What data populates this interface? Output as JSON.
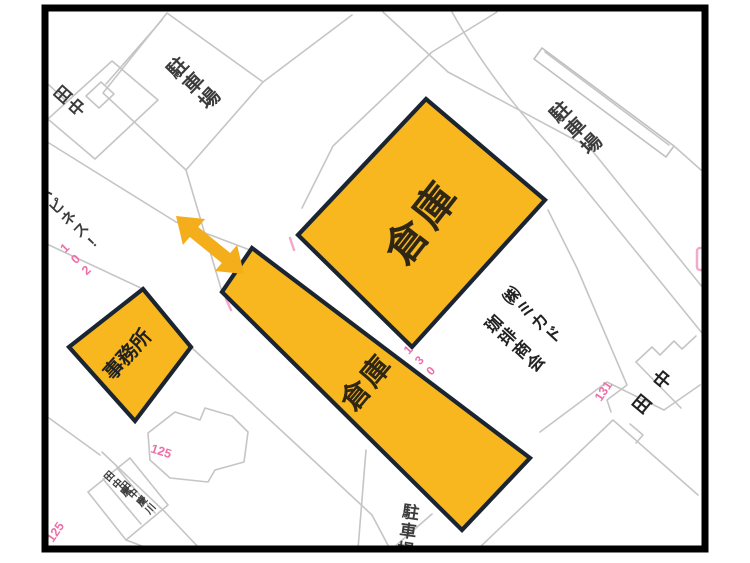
{
  "map": {
    "buildings": {
      "warehouse_large": {
        "label": "倉庫"
      },
      "warehouse_long": {
        "label": "倉庫"
      },
      "office": {
        "label": "事務所"
      }
    },
    "labels": {
      "parking_top_left": "駐車場",
      "parking_top_right": "駐車場",
      "parking_bottom": "駐車場",
      "tanaka_top_left": "田中",
      "tanaka_right": "田中",
      "happiness": "ハピネス!",
      "mikado_line1": "㈱ミカド",
      "mikado_line2": "珈琲商会"
    },
    "names_bottom": [
      "田中慶",
      "田中慶川"
    ],
    "numbers": {
      "num_102": "102",
      "num_125_a": "125",
      "num_125_b": "125",
      "num_130": "130",
      "num_131": "131"
    },
    "colors": {
      "building_fill": "#F8B71F",
      "building_stroke": "#1A2531",
      "arrow": "#F4AD1B",
      "parcel_line": "#C5C5C5",
      "number_pink": "#EE6FA8",
      "frame": "#000000",
      "kanji_text": "#3C3C3C",
      "warehouse_text": "#2F2714"
    }
  }
}
